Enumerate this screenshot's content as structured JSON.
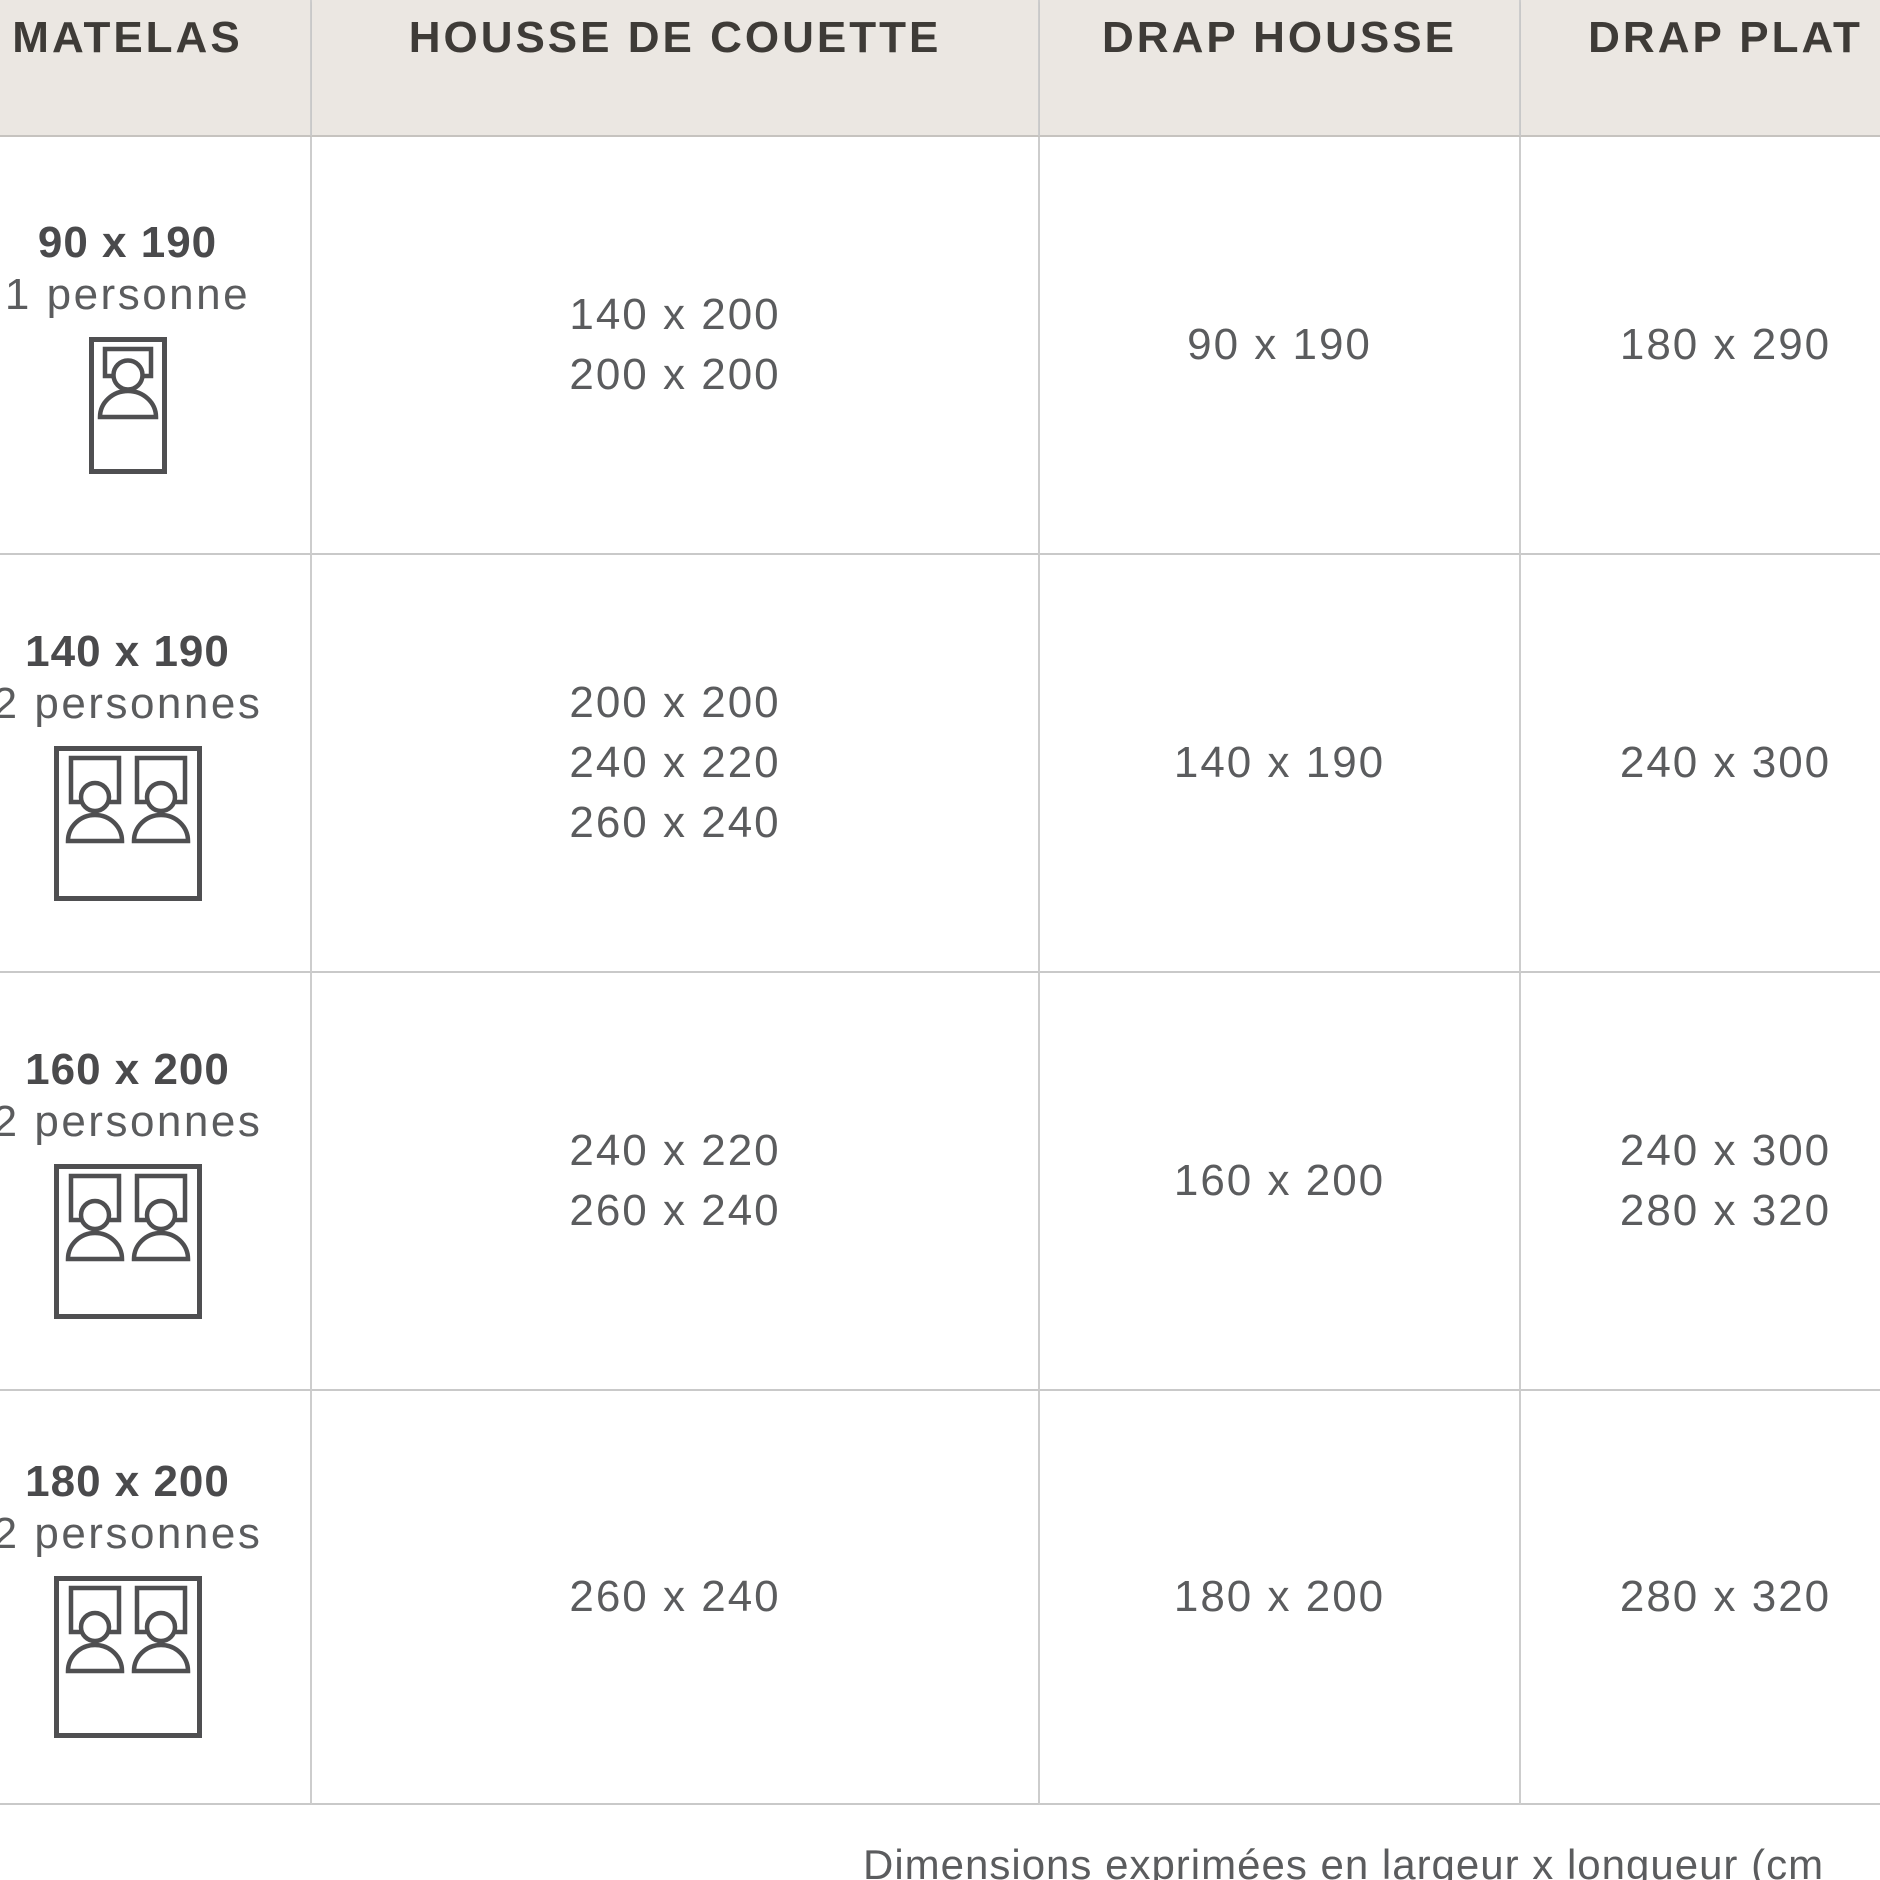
{
  "table": {
    "columns": [
      {
        "label": "MATELAS"
      },
      {
        "label": "HOUSSE DE COUETTE"
      },
      {
        "label": "DRAP HOUSSE"
      },
      {
        "label": "DRAP PLAT"
      }
    ],
    "rows": [
      {
        "matelas_size": "90 x 190",
        "persons": "1 personne",
        "bed_icon": "single-bed",
        "housse_de_couette": [
          "140 x 200",
          "200 x 200"
        ],
        "drap_housse": [
          "90 x 190"
        ],
        "drap_plat": [
          "180 x 290"
        ]
      },
      {
        "matelas_size": "140 x 190",
        "persons": "2 personnes",
        "bed_icon": "double-bed",
        "housse_de_couette": [
          "200 x 200",
          "240 x 220",
          "260 x 240"
        ],
        "drap_housse": [
          "140 x 190"
        ],
        "drap_plat": [
          "240 x 300"
        ]
      },
      {
        "matelas_size": "160 x 200",
        "persons": "2 personnes",
        "bed_icon": "double-bed",
        "housse_de_couette": [
          "240 x 220",
          "260 x 240"
        ],
        "drap_housse": [
          "160 x 200"
        ],
        "drap_plat": [
          "240 x 300",
          "280 x 320"
        ]
      },
      {
        "matelas_size": "180 x 200",
        "persons": "2 personnes",
        "bed_icon": "double-bed",
        "housse_de_couette": [
          "260 x 240"
        ],
        "drap_housse": [
          "180 x 200"
        ],
        "drap_plat": [
          "280 x 320"
        ]
      }
    ],
    "footnote": "Dimensions exprimées en largeur x longueur (cm"
  },
  "colors": {
    "header_background": "#ebe7e2",
    "header_text": "#3e3b37",
    "body_text": "#5b5c5e",
    "strong_text": "#4a4a4c",
    "border": "#c9c9c9",
    "icon_stroke": "#4f4f51",
    "background": "#ffffff"
  }
}
